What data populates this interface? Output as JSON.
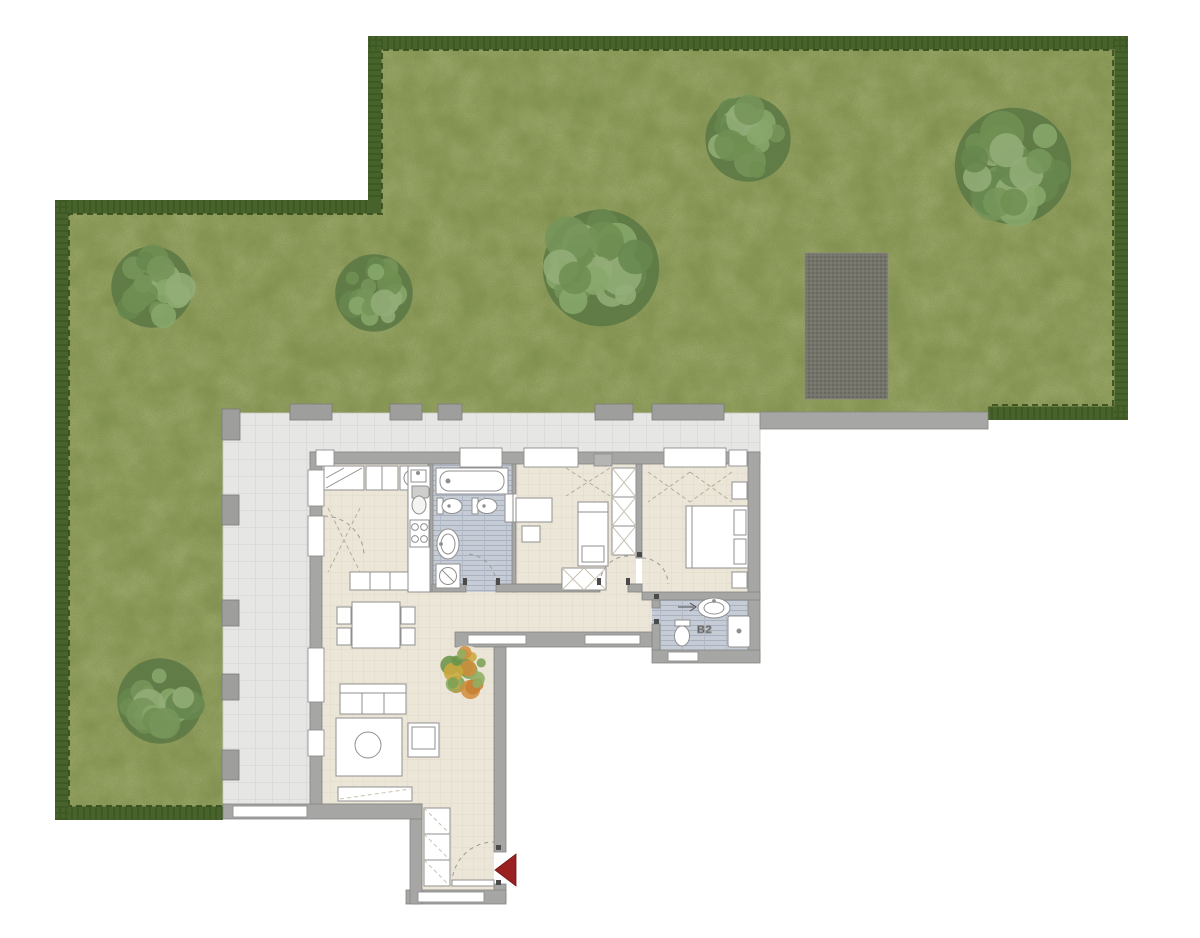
{
  "labels": {
    "bathroom2": "B2"
  },
  "colors": {
    "background": "#ffffff",
    "grass_base": "#83914d",
    "grass_dark_noise": "#2e3c13",
    "grass_light_noise": "#b9c26a",
    "hedge": "#47622a",
    "hedge_inner_line": "#2b4214",
    "tree_base": "#5d7a45",
    "tree_blobs": [
      "#76955a",
      "#88a76b",
      "#67874e",
      "#93ad77",
      "#6f9052"
    ],
    "deco_tree_blobs": [
      "#7ba055",
      "#d18f3c",
      "#8fae63",
      "#c9a83f",
      "#6a9348",
      "#c77f35"
    ],
    "gravel": "#74746b",
    "gravel_dot": "#5a5a52",
    "terrace_tile": "#e6e6e4",
    "terrace_line": "#d3d3d0",
    "parapet": "#9e9e9c",
    "wall": "#a6a6a4",
    "wall_outline": "#858583",
    "floor": "#ece6d8",
    "floor_line": "#ded7c5",
    "bath_floor": "#c6ccd6",
    "bath_stripe": "#a9b1c0",
    "fixture_fill": "#ffffff",
    "fixture_outline": "#8f8f8f",
    "closet_dash": "#b5ad99",
    "swing_dash": "#9a9a98",
    "hinge": "#4a4a4a",
    "entrance_arrow": "#9b2121",
    "label_text": "#3c3c3c"
  },
  "garden": {
    "trees": [
      {
        "x": 152,
        "y": 287,
        "r": 42
      },
      {
        "x": 374,
        "y": 293,
        "r": 40
      },
      {
        "x": 601,
        "y": 268,
        "r": 60
      },
      {
        "x": 748,
        "y": 139,
        "r": 44
      },
      {
        "x": 1013,
        "y": 166,
        "r": 60
      },
      {
        "x": 160,
        "y": 701,
        "r": 44
      }
    ],
    "decorative_tree": {
      "x": 466,
      "y": 671,
      "r": 26
    },
    "gravel_patch": {
      "x": 805,
      "y": 253,
      "w": 83,
      "h": 146
    }
  }
}
